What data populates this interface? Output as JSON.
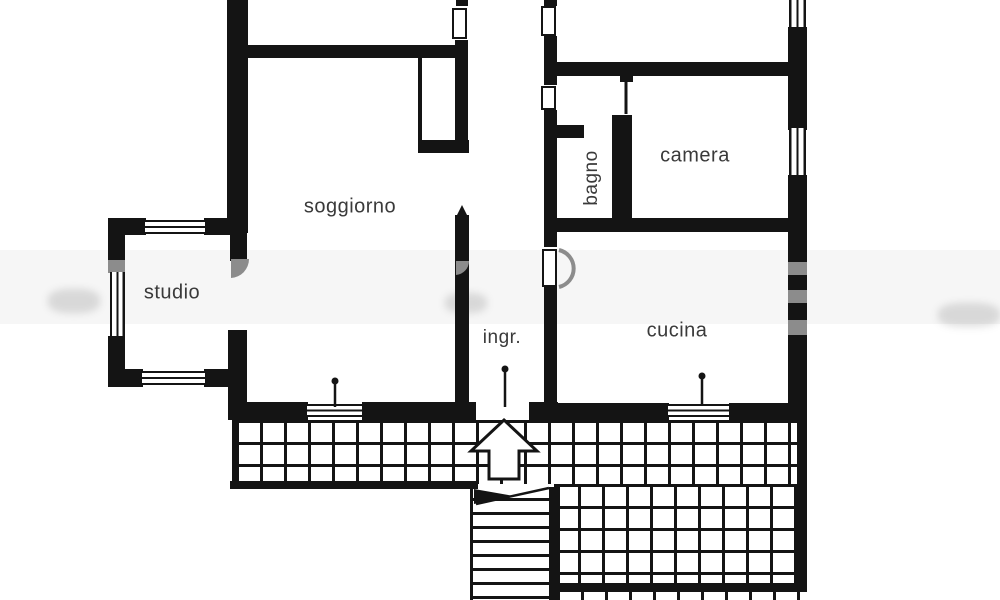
{
  "colors": {
    "wall": "#141414",
    "gray": "#8c8c8c",
    "label": "#3a3a3a",
    "background": "#ffffff"
  },
  "rooms": {
    "soggiorno": {
      "label": "soggiorno"
    },
    "studio": {
      "label": "studio"
    },
    "bagno": {
      "label": "bagno"
    },
    "camera": {
      "label": "camera"
    },
    "cucina": {
      "label": "cucina"
    },
    "ingresso": {
      "label": "ingr."
    }
  },
  "icons": {
    "entrance_arrow": "up-arrow",
    "terrace_hatch": "square-grid-hatch",
    "staircase": "stair-treads"
  }
}
